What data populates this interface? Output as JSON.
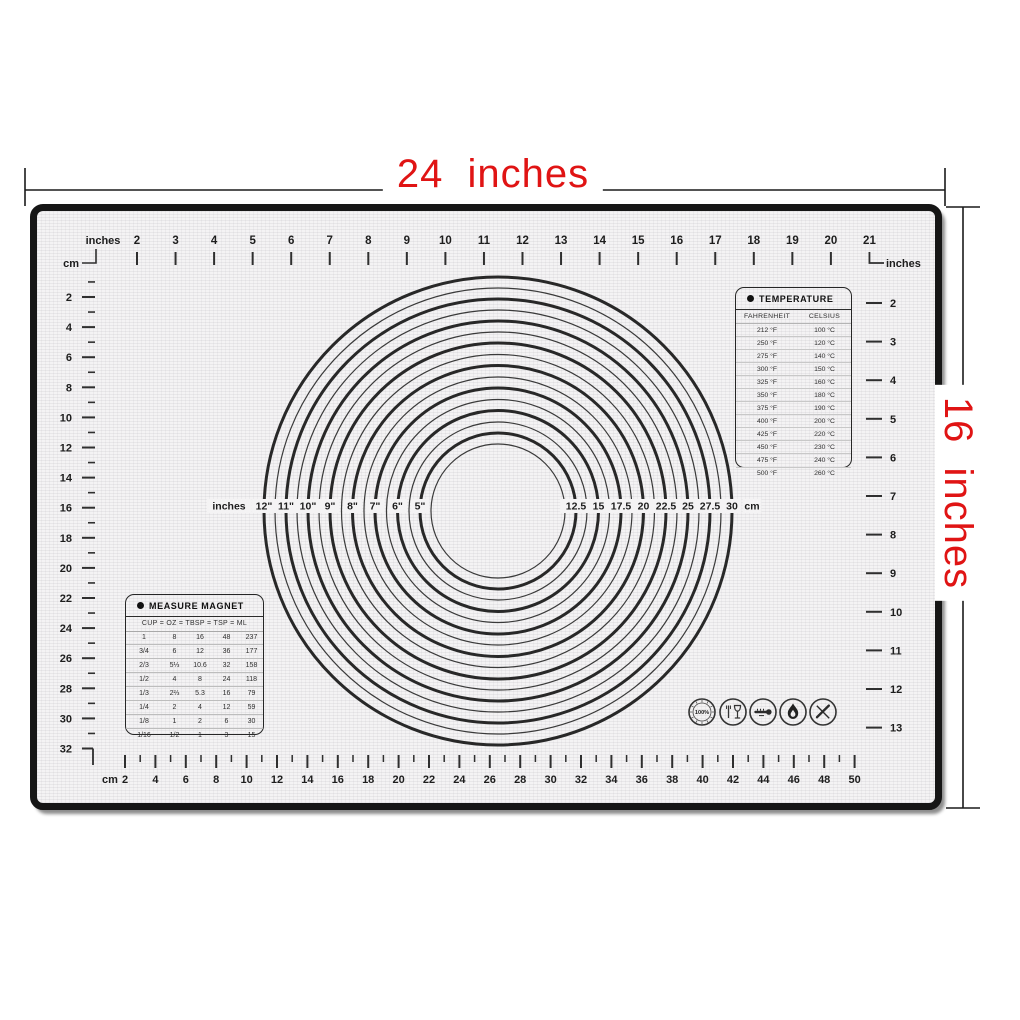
{
  "product": {
    "width_label": "24  inches",
    "height_label": "16  inches"
  },
  "colors": {
    "accent_red": "#e01414",
    "mark": "#2f2f2f",
    "mat_bg": "#f4f3f4",
    "mat_border": "#161616",
    "dim_line": "#1a1a1a"
  },
  "rulers": {
    "top_inches": {
      "label": "inches",
      "corner_label": "cm",
      "numbers": [
        2,
        3,
        4,
        5,
        6,
        7,
        8,
        9,
        10,
        11,
        12,
        13,
        14,
        15,
        16,
        17,
        18,
        19,
        20,
        21
      ]
    },
    "left_cm": {
      "label": "cm",
      "numbers": [
        2,
        4,
        6,
        8,
        10,
        12,
        14,
        16,
        18,
        20,
        22,
        24,
        26,
        28,
        30,
        32
      ]
    },
    "right_inches": {
      "label": "inches",
      "numbers": [
        2,
        3,
        4,
        5,
        6,
        7,
        8,
        9,
        10,
        11,
        12,
        13
      ]
    },
    "bottom_cm": {
      "label": "cm",
      "numbers": [
        2,
        4,
        6,
        8,
        10,
        12,
        14,
        16,
        18,
        20,
        22,
        24,
        26,
        28,
        30,
        32,
        34,
        36,
        38,
        40,
        42,
        44,
        46,
        48,
        50
      ]
    }
  },
  "circles": {
    "left_unit": "inches",
    "right_unit": "cm",
    "inch_labels": [
      "12\"",
      "11\"",
      "10\"",
      "9\"",
      "8\"",
      "7\"",
      "6\"",
      "5\""
    ],
    "cm_labels": [
      "12.5",
      "15",
      "17.5",
      "20",
      "22.5",
      "25",
      "27.5",
      "30"
    ]
  },
  "temperature_table": {
    "title": "TEMPERATURE",
    "columns": [
      "FAHRENHEIT",
      "CELSIUS"
    ],
    "rows": [
      [
        "212 °F",
        "100 °C"
      ],
      [
        "250 °F",
        "120 °C"
      ],
      [
        "275 °F",
        "140 °C"
      ],
      [
        "300 °F",
        "150 °C"
      ],
      [
        "325 °F",
        "160 °C"
      ],
      [
        "350 °F",
        "180 °C"
      ],
      [
        "375 °F",
        "190 °C"
      ],
      [
        "400 °F",
        "200 °C"
      ],
      [
        "425 °F",
        "220 °C"
      ],
      [
        "450 °F",
        "230 °C"
      ],
      [
        "475 °F",
        "240 °C"
      ],
      [
        "500 °F",
        "260 °C"
      ]
    ]
  },
  "measure_table": {
    "title": "MEASURE MAGNET",
    "header": "CUP  =  OZ  =  TBSP  =  TSP  =  ML",
    "rows": [
      [
        "1",
        "8",
        "16",
        "48",
        "237"
      ],
      [
        "3/4",
        "6",
        "12",
        "36",
        "177"
      ],
      [
        "2/3",
        "5⅓",
        "10.6",
        "32",
        "158"
      ],
      [
        "1/2",
        "4",
        "8",
        "24",
        "118"
      ],
      [
        "1/3",
        "2⅔",
        "5.3",
        "16",
        "79"
      ],
      [
        "1/4",
        "2",
        "4",
        "12",
        "59"
      ],
      [
        "1/8",
        "1",
        "2",
        "6",
        "30"
      ],
      [
        "1/16",
        "1/2",
        "1",
        "3",
        "15"
      ]
    ]
  },
  "icons": [
    {
      "name": "quality-100-percent-icon",
      "label": "100%"
    },
    {
      "name": "food-safe-glass-icon",
      "label": ""
    },
    {
      "name": "thermometer-icon",
      "label": ""
    },
    {
      "name": "flame-icon",
      "label": ""
    },
    {
      "name": "no-knife-icon",
      "label": ""
    }
  ]
}
